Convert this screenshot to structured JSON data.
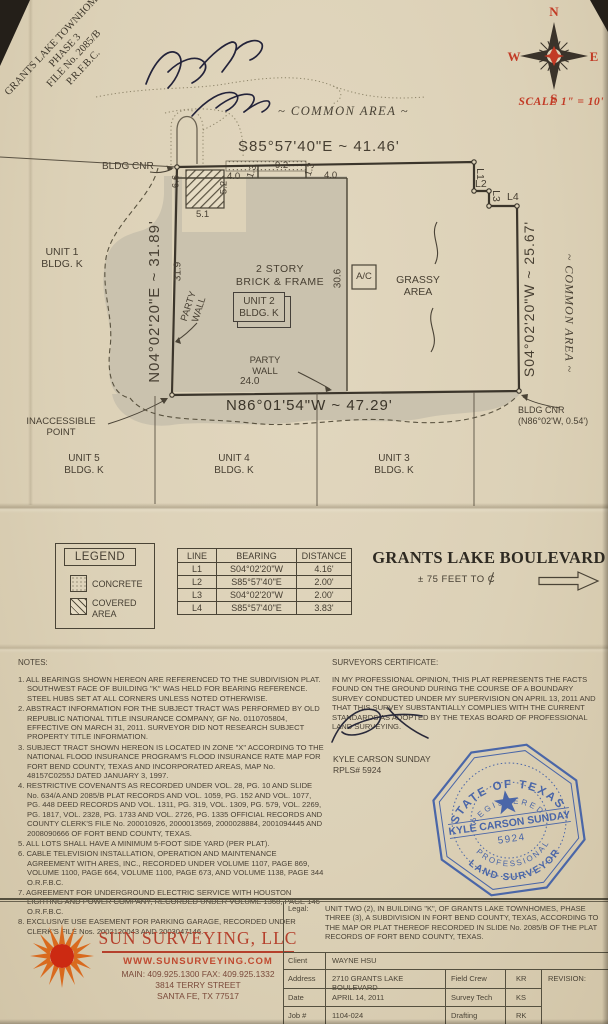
{
  "plat": {
    "subdivision_label": {
      "line1": "GRANTS LAKE TOWNHOMES",
      "line2": "PHASE 3",
      "line3": "FILE No. 2085/B",
      "line4": "P.R.F.B.C."
    },
    "compass": {
      "n": "N",
      "e": "E",
      "s": "S",
      "w": "W"
    },
    "scale": "SCALE  1\" = 10'",
    "common_area_top": "~ COMMON AREA ~",
    "common_area_right": "~ COMMON AREA ~",
    "bearings": {
      "top": "S85°57'40\"E  ~  41.46'",
      "right": "S04°02'20\"W  ~  25.67'",
      "bottom": "N86°01'54\"W  ~  47.29'",
      "left": "N04°02'20\"E  ~  31.89'"
    },
    "labels": {
      "bldg_cnr_top": "BLDG CNR",
      "bldg_cnr_bottom_1": "BLDG CNR",
      "bldg_cnr_bottom_2": "(N86°02'W, 0.54')",
      "grassy_1": "GRASSY",
      "grassy_2": "AREA",
      "story_1": "2 STORY",
      "story_2": "BRICK & FRAME",
      "unit2_1": "UNIT 2",
      "unit2_2": "BLDG. K",
      "party_wall_1": "PARTY",
      "party_wall_2": "WALL",
      "party_wall_b1": "PARTY",
      "party_wall_b2": "WALL",
      "ac": "A/C",
      "inaccessible_1": "INACCESSIBLE",
      "inaccessible_2": "POINT",
      "unit1_1": "UNIT 1",
      "unit1_2": "BLDG. K",
      "unit3_1": "UNIT 3",
      "unit3_2": "BLDG. K",
      "unit4_1": "UNIT 4",
      "unit4_2": "BLDG. K",
      "unit5_1": "UNIT 5",
      "unit5_2": "BLDG. K",
      "l1": "L1",
      "l2": "L2",
      "l3": "L3",
      "l4": "L4"
    },
    "dims": {
      "d66": "6.6",
      "d40a": "4.0",
      "d52": "5.2",
      "d51": "5.1",
      "d13a": "1.3",
      "d92": "9.2",
      "d13b": "1.3",
      "d40b": "4.0",
      "d319": "31.9",
      "d306": "30.6",
      "d240": "24.0"
    }
  },
  "legend": {
    "title": "LEGEND",
    "concrete": "CONCRETE",
    "covered_1": "COVERED",
    "covered_2": "AREA"
  },
  "line_table": {
    "headers": [
      "LINE",
      "BEARING",
      "DISTANCE"
    ],
    "rows": [
      {
        "line": "L1",
        "bearing": "S04°02'20\"W",
        "distance": "4.16'"
      },
      {
        "line": "L2",
        "bearing": "S85°57'40\"E",
        "distance": "2.00'"
      },
      {
        "line": "L3",
        "bearing": "S04°02'20\"W",
        "distance": "2.00'"
      },
      {
        "line": "L4",
        "bearing": "S85°57'40\"E",
        "distance": "3.83'"
      }
    ]
  },
  "street": {
    "name": "GRANTS LAKE BOULEVARD",
    "feet_to": "± 75   FEET TO",
    "cl_char": "C"
  },
  "notes": {
    "heading": "NOTES:",
    "items": [
      "1. ALL BEARINGS SHOWN HEREON ARE REFERENCED TO THE SUBDIVISION PLAT. SOUTHWEST FACE OF BUILDING \"K\" WAS HELD FOR BEARING REFERENCE. STEEL HUBS SET AT ALL CORNERS UNLESS NOTED OTHERWISE.",
      "2. ABSTRACT INFORMATION FOR THE SUBJECT TRACT WAS PERFORMED BY OLD REPUBLIC NATIONAL TITLE INSURANCE COMPANY, GF No. 0110705804, EFFECTIVE ON MARCH 31, 2011. SURVEYOR DID NOT RESEARCH SUBJECT PROPERTY TITLE INFORMATION.",
      "3. SUBJECT TRACT SHOWN HEREON IS LOCATED IN ZONE \"X\" ACCORDING TO THE NATIONAL FLOOD INSURANCE PROGRAM'S FLOOD INSURANCE RATE MAP FOR FORT BEND COUNTY, TEXAS AND INCORPORATED AREAS, MAP No. 48157C0255J DATED JANUARY 3, 1997.",
      "4. RESTRICTIVE COVENANTS AS RECORDED UNDER VOL. 28, PG. 10 AND SLIDE No. 634/A AND 2085/B PLAT RECORDS AND VOL. 1059, PG. 152 AND VOL. 1077, PG. 448 DEED RECORDS AND VOL. 1311, PG. 319, VOL. 1309, PG. 579, VOL. 2269, PG. 1817, VOL. 2328, PG. 1733 AND VOL. 2726, PG. 1335 OFFICIAL RECORDS AND COUNTY CLERK'S FILE No. 200010926, 2000013569, 2000028884, 2001094445 AND 2008090666 OF FORT BEND COUNTY, TEXAS.",
      "5. ALL LOTS SHALL HAVE A MINIMUM 5-FOOT SIDE YARD (PER PLAT).",
      "6. CABLE TELEVISION INSTALLATION, OPERATION AND MAINTENANCE AGREEMENT WITH ARES, INC., RECORDED UNDER VOLUME 1107, PAGE 869, VOLUME 1100, PAGE 664, VOLUME 1100, PAGE 673, AND VOLUME 1138, PAGE 344 O.R.F.B.C.",
      "7. AGREEMENT FOR UNDERGROUND ELECTRIC SERVICE WITH HOUSTON LIGHTING AND POWER COMPANY, RECORDED UNDER VOLUME 1368, PAGE 146 O.R.F.B.C.",
      "8. EXCLUSIVE USE EASEMENT FOR PARKING GARAGE, RECORDED UNDER CLERK'S FILE Nos. 2002120043 AND 2003047146."
    ]
  },
  "certificate": {
    "heading": "SURVEYORS CERTIFICATE:",
    "body": "IN MY PROFESSIONAL OPINION, THIS PLAT REPRESENTS THE FACTS FOUND ON THE GROUND DURING THE COURSE OF A BOUNDARY SURVEY CONDUCTED UNDER MY SUPERVISION ON APRIL 13, 2011 AND THAT THIS SURVEY SUBSTANTIALLY COMPLIES WITH THE CURRENT STANDARDS AS ADOPTED BY THE TEXAS BOARD OF PROFESSIONAL LAND SURVEYING.",
    "surveyor": "KYLE CARSON SUNDAY",
    "license": "RPLS# 5924"
  },
  "seal": {
    "top": "STATE OF TEXAS",
    "registered": "REGISTERED",
    "name": "KYLE CARSON SUNDAY",
    "number": "5924",
    "professional": "PROFESSIONAL",
    "bottom": "LAND SURVEYOR"
  },
  "firm": {
    "name": "SUN SURVEYING, LLC",
    "website": "WWW.SUNSURVEYING.COM",
    "phone": "MAIN: 409.925.1300  FAX: 409.925.1332",
    "address_1": "3814 TERRY STREET",
    "address_2": "SANTA FE, TX 77517"
  },
  "title_table": {
    "legal_label": "Legal:",
    "legal_text": "UNIT TWO (2), IN BUILDING \"K\", OF GRANTS LAKE TOWNHOMES, PHASE THREE (3), A SUBDIVISION IN FORT BEND COUNTY, TEXAS, ACCORDING TO THE MAP OR PLAT THEREOF RECORDED IN SLIDE No. 2085/B OF THE PLAT RECORDS OF FORT BEND COUNTY, TEXAS.",
    "client_label": "Client",
    "client": "WAYNE HSU",
    "address_label": "Address",
    "address": "2710 GRANTS LAKE BOULEVARD",
    "date_label": "Date",
    "date": "APRIL 14, 2011",
    "job_label": "Job #",
    "job": "1104-024",
    "field_crew_label": "Field Crew",
    "field_crew": "KR",
    "survey_tech_label": "Survey Tech",
    "survey_tech": "KS",
    "drafting_label": "Drafting",
    "drafting": "RK",
    "revision_label": "REVISION:"
  }
}
